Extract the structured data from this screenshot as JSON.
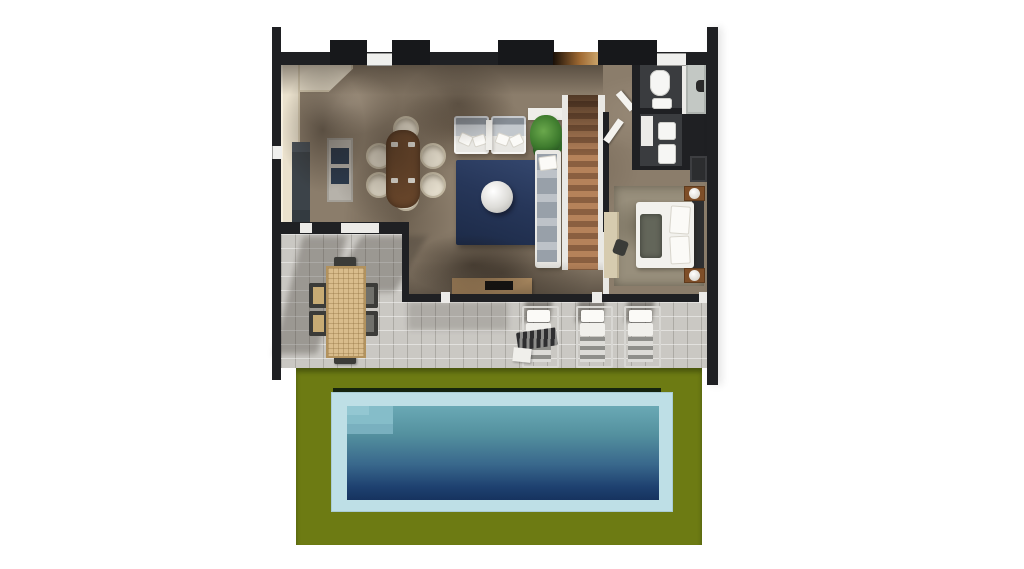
{
  "scene": {
    "type": "3d-floor-plan-top-view",
    "description": "Single-storey villa render: open-plan kitchen, dining and living room, staircase, two bathrooms, bedroom, covered terrace with outdoor dining and sun loungers, lawn with rectangular swimming pool",
    "rooms": [
      "kitchen",
      "dining-area",
      "living-room",
      "staircase",
      "hallway",
      "bathroom-1",
      "bathroom-2",
      "bedroom",
      "terrace",
      "lawn",
      "swimming-pool"
    ],
    "furniture": {
      "kitchen": [
        "l-shaped-counter",
        "fridge",
        "island-with-sink"
      ],
      "dining-area": [
        "wood-table",
        "six-cream-chairs"
      ],
      "living-room": [
        "two-gray-sofas",
        "plant",
        "navy-rug",
        "round-coffee-table",
        "chaise-sofa",
        "tv-console"
      ],
      "bedroom": [
        "double-bed",
        "two-nightstands-with-lamps",
        "desk",
        "desk-chair",
        "wardrobe"
      ],
      "bathroom-1": [
        "toilet",
        "sink",
        "walk-in-shower"
      ],
      "bathroom-2": [
        "sink",
        "shower-tray"
      ],
      "terrace": [
        "outdoor-dining-table",
        "six-outdoor-chairs",
        "three-sun-loungers",
        "striped-towel",
        "white-towel"
      ]
    },
    "pool": {
      "shape": "rectangle",
      "steps": "top-left-corner",
      "surround": "light-blue-coping",
      "setting": "olive-green-lawn"
    }
  },
  "palette": {
    "wall": "#1f2023",
    "floor": "#8b7d6b",
    "counter": "#eae1cd",
    "wood": "#6f4a2d",
    "chair": "#eae3d2",
    "rug": "#27375a",
    "stairs-a": "#b5825a",
    "stairs-b": "#8a5f40",
    "bed": "#f2f1ed",
    "night": "#7e4e28",
    "bath-floor": "#3a3c3f",
    "fixture": "#f6f6f4",
    "terrace": "#cac8c3",
    "out-table": "#d9bc8c",
    "lawn": "#6d7b13",
    "coping": "#bedfe6",
    "water-top": "#6aa9b5",
    "water-deep": "#16335f"
  }
}
